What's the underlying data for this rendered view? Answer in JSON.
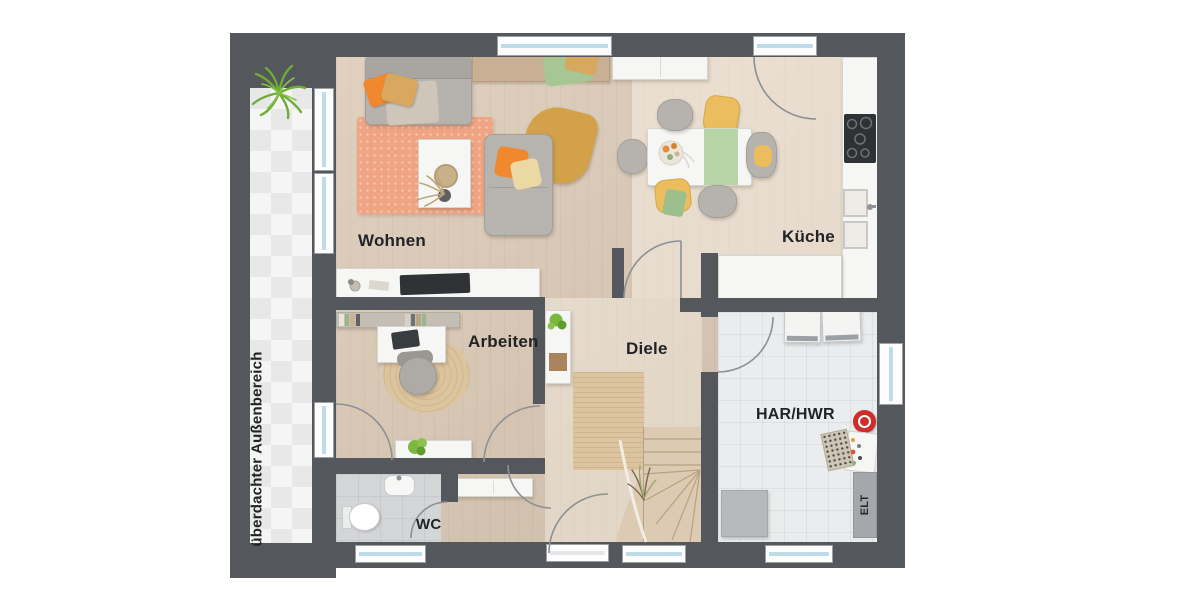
{
  "plan": {
    "labels": {
      "wohnen": "Wohnen",
      "kueche": "Küche",
      "arbeiten": "Arbeiten",
      "diele": "Diele",
      "har_hwr": "HAR/HWR",
      "wc": "WC",
      "elt": "ELT",
      "outdoor": "überdachter Außenbereich"
    },
    "colors": {
      "wall": "#54585c",
      "wood_floor": "#d8c5b0",
      "kitchen_wash": "#ece0cf",
      "outdoor_tile": "#f1f1f1",
      "wc_tile": "#d4d5d7",
      "har_tile": "#ebeced",
      "living_rug": "#efa583",
      "jute_rug": "#dcc49e",
      "window_glass": "#bedbe9",
      "accent_orange": "#f0882e",
      "accent_ochre": "#d9a75f",
      "accent_mustard": "#d2a149",
      "accent_yellow": "#ecbd5e",
      "accent_green": "#a6c693",
      "appliance_red": "#cf2d2a",
      "label_text": "#212326"
    }
  }
}
